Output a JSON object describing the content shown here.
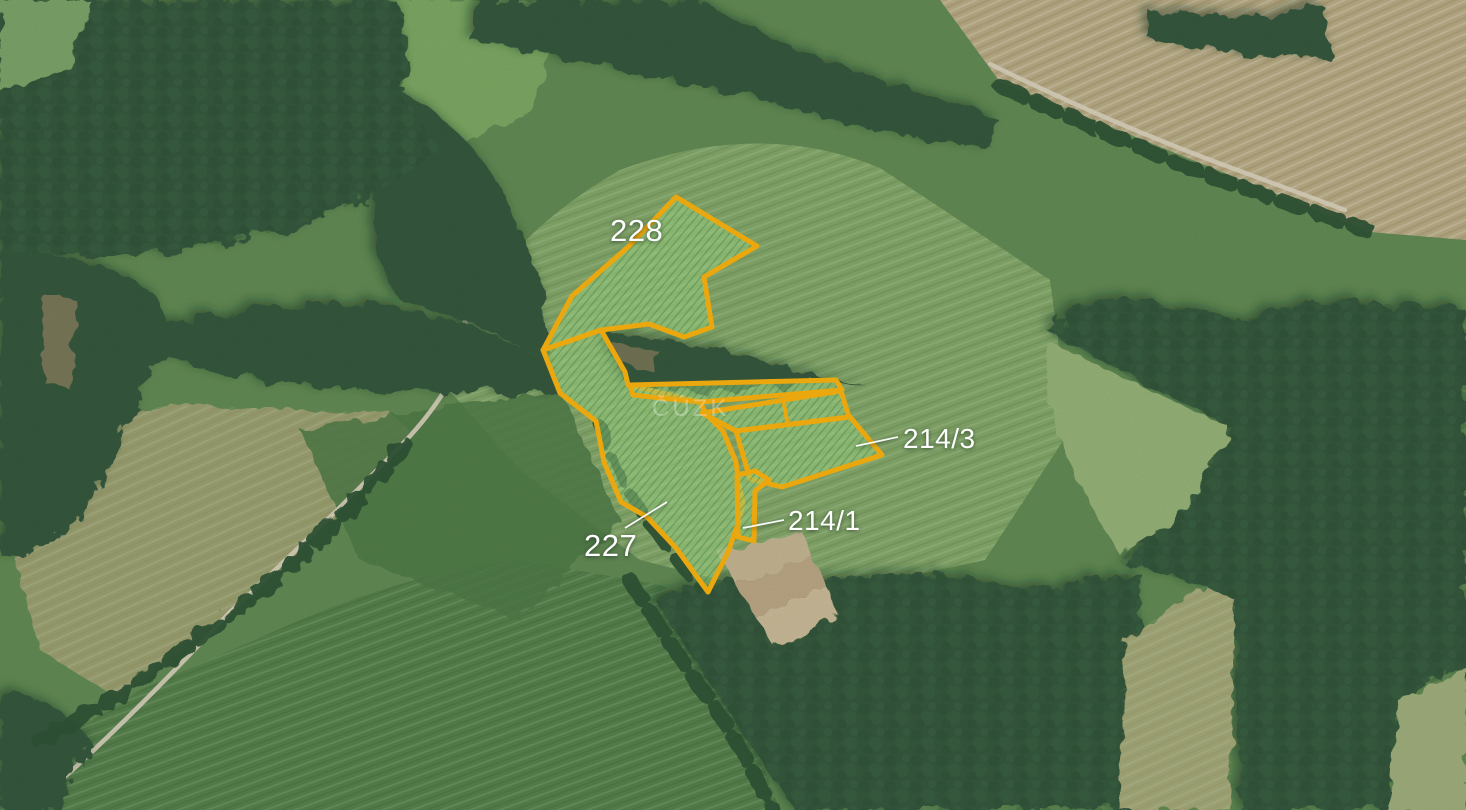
{
  "colors": {
    "parcel_outline": "#eba70e",
    "parcel_fill": "#98cf7e",
    "label_color": "#ffffff"
  },
  "watermark": {
    "text": "ČÚZK"
  },
  "parcels": [
    {
      "id": "228",
      "label": "228"
    },
    {
      "id": "227",
      "label": "227"
    },
    {
      "id": "214/3",
      "label": "214/3"
    },
    {
      "id": "214/1",
      "label": "214/1"
    }
  ]
}
